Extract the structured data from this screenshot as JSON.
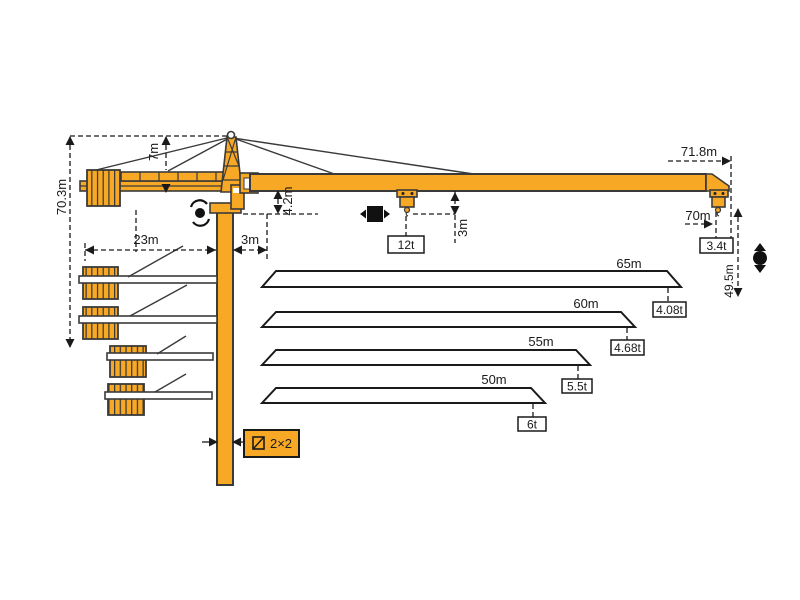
{
  "colors": {
    "crane": "#F7A824",
    "outline": "#3A3A3A",
    "annotation": "#1A1A1A",
    "background": "#FFFFFF"
  },
  "dimensions": {
    "total_height": "70.3m",
    "tower_head_height": "7m",
    "counter_jib_radius": "23m",
    "rear_offset": "3m",
    "jib_depth": "4.2m",
    "hook_clearance": "3m",
    "max_radius": "71.8m",
    "max_hook_radius": "70m",
    "hook_height": "49.5m"
  },
  "loads": {
    "max_capacity": "12t",
    "tip_capacity": "3.4t"
  },
  "mast": {
    "section": "2×2"
  },
  "jib_options": [
    {
      "length": "65m",
      "tip_capacity": "4.08t"
    },
    {
      "length": "60m",
      "tip_capacity": "4.68t"
    },
    {
      "length": "55m",
      "tip_capacity": "5.5t"
    },
    {
      "length": "50m",
      "tip_capacity": "6t"
    }
  ],
  "icons": {
    "slew": "slewing-rotation",
    "trolley": "trolley-travel",
    "hoist": "hoist-up-down"
  }
}
